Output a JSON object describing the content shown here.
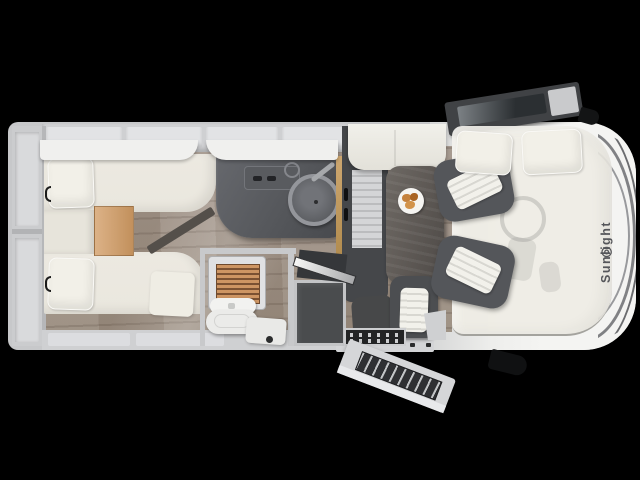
{
  "brand": {
    "name": "Sunlight",
    "logo_glyph": "◎"
  },
  "colors": {
    "background": "#000000",
    "body_gray": "#c7c8ca",
    "body_white": "#f4f4f2",
    "wall_gray": "#cfd0d2",
    "cabinet_light": "#e2e3e5",
    "bed_cream": "#eae7de",
    "pillow_cream": "#f2f0e8",
    "dark_furniture": "#4a4c4e",
    "counter_dark": "#55575b",
    "oak": "#cda770",
    "floor_wood": "#998c7f",
    "table_dark": "#5d5854",
    "food": "#c5823e",
    "brand_text": "#55565a"
  },
  "floorplan": {
    "view": "top-down",
    "vehicle": "motorhome",
    "areas": [
      {
        "id": "rear-garage",
        "label": "Rear storage"
      },
      {
        "id": "twin-beds",
        "label": "Twin single beds with wooden step"
      },
      {
        "id": "kitchen",
        "label": "Kitchen with round sink and hob"
      },
      {
        "id": "bathroom",
        "label": "Bathroom with shower, toilet and washbasin"
      },
      {
        "id": "wardrobe",
        "label": "Wardrobe"
      },
      {
        "id": "dinette",
        "label": "Dinette with table and bench"
      },
      {
        "id": "entrance",
        "label": "Entrance with open door and step mat"
      },
      {
        "id": "cab",
        "label": "Driver cab with two swivel seats"
      },
      {
        "id": "drop-down-bed",
        "label": "Drop-down bed over cab"
      }
    ]
  }
}
